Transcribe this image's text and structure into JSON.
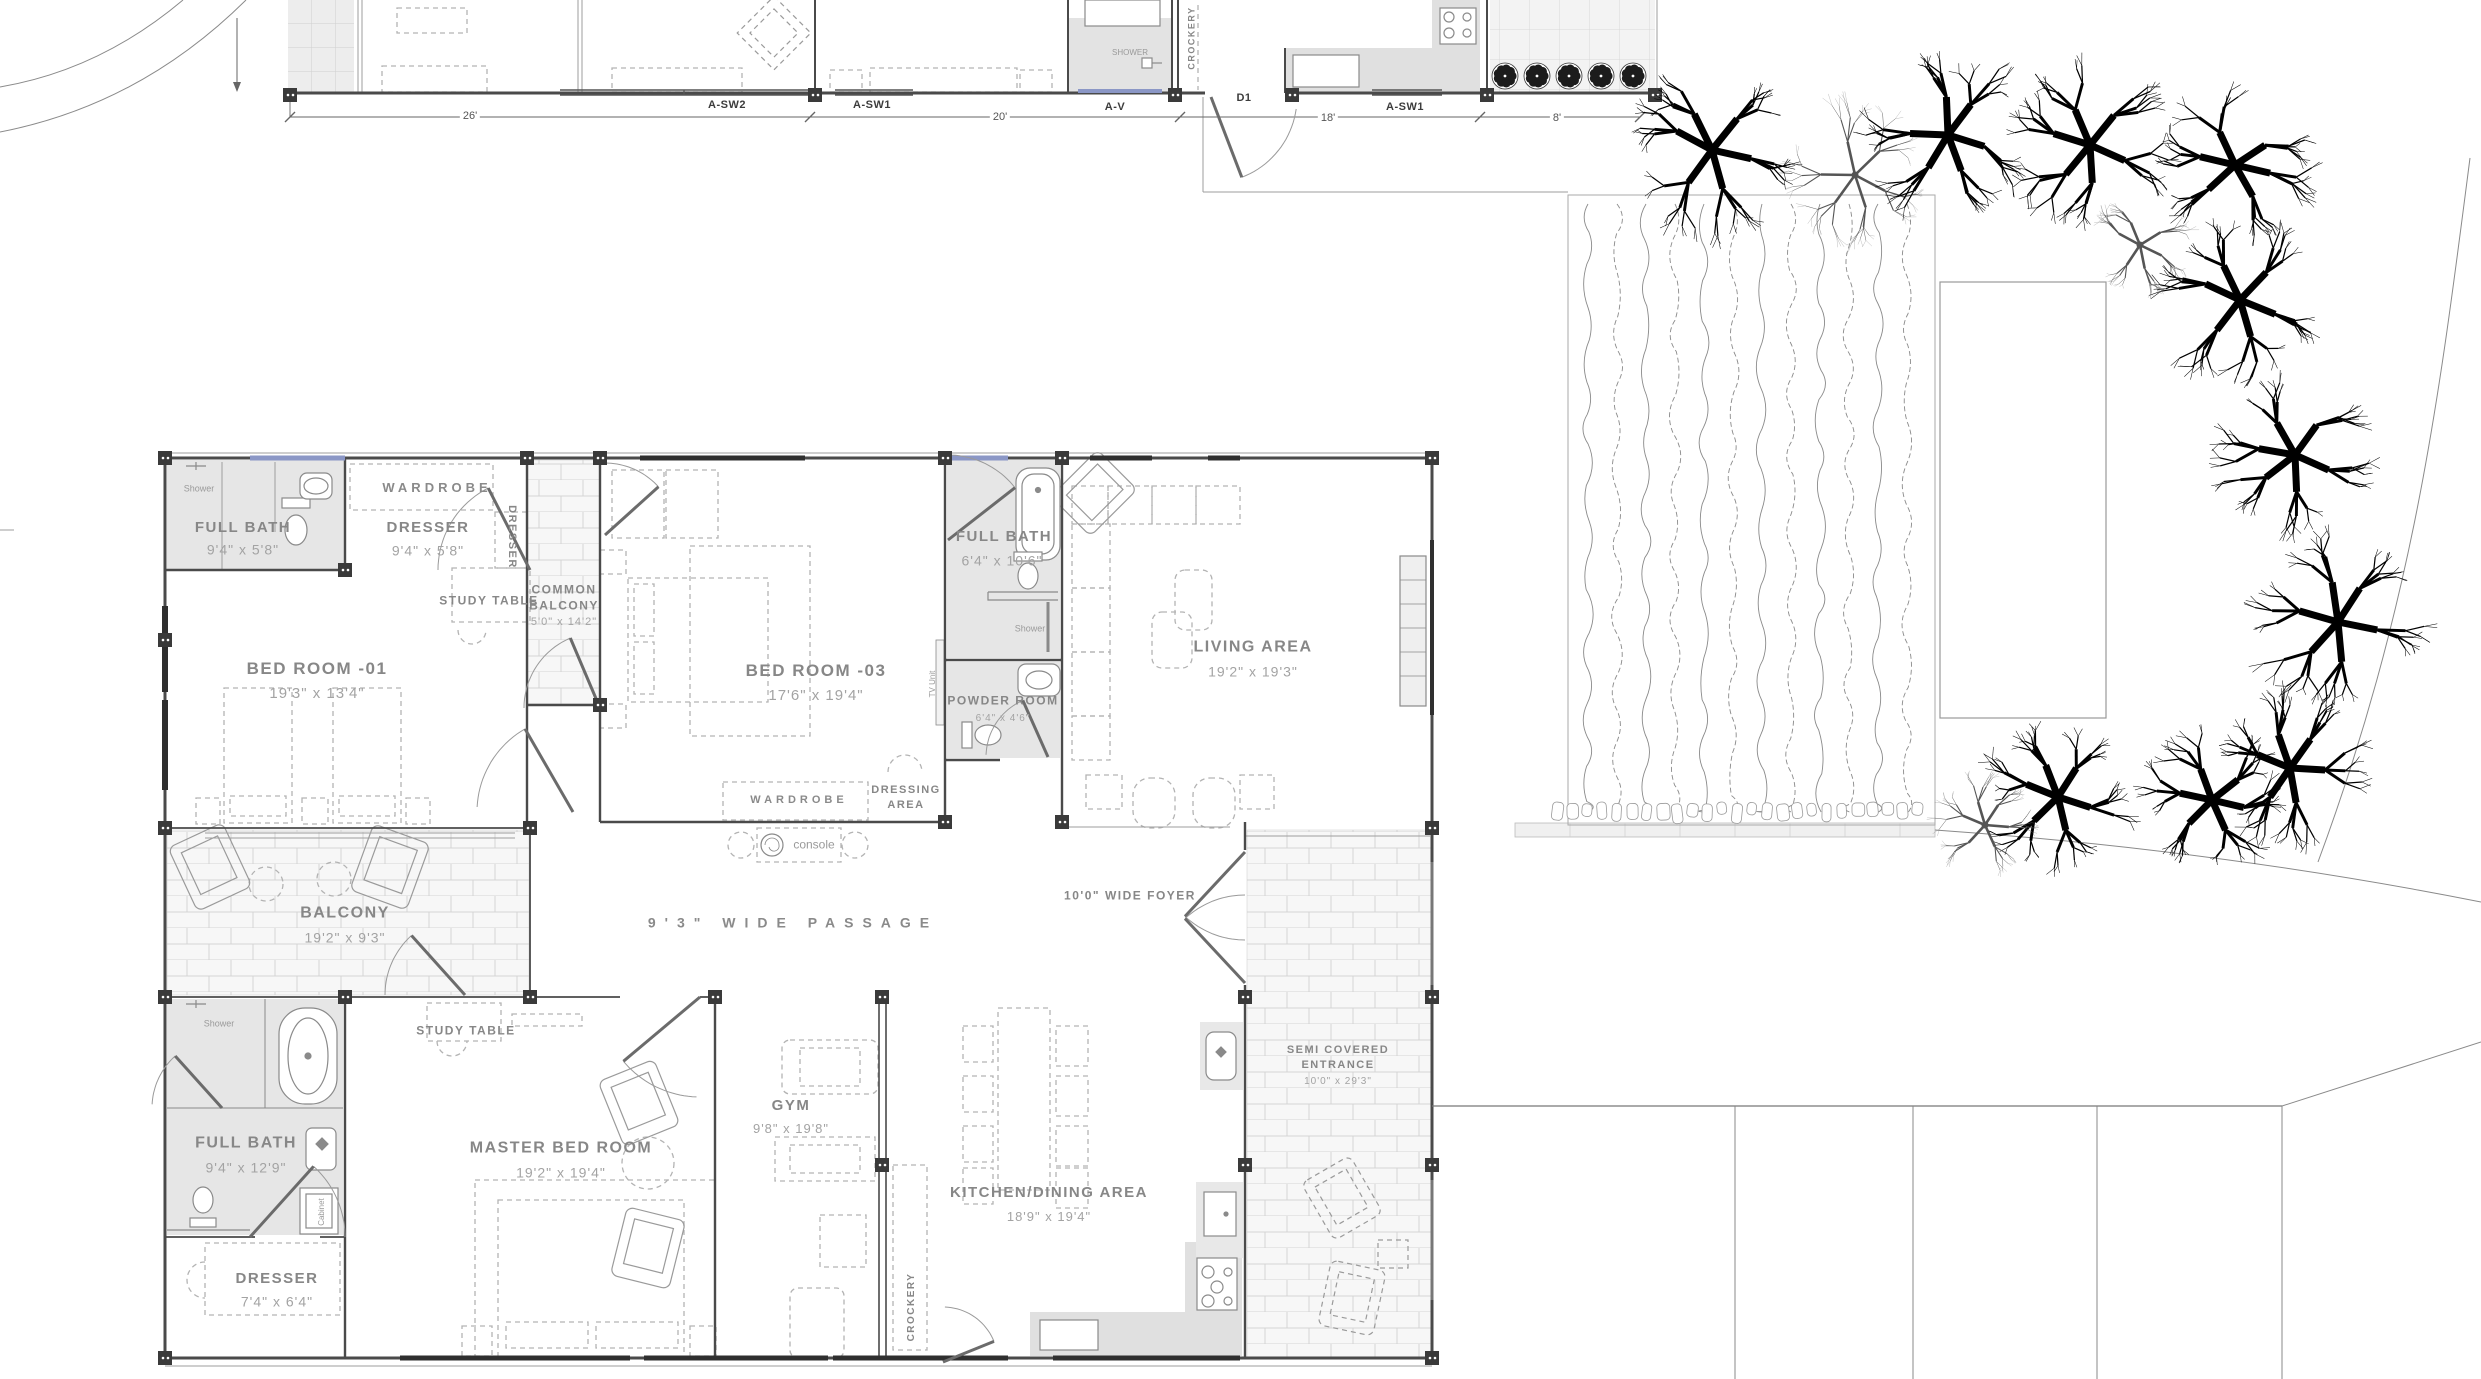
{
  "colors": {
    "wall": "#4a4a4a",
    "room_fill": "#e6e6e6",
    "brick_line": "#d4d4d4",
    "label": "#8f8f8f",
    "window_glass": "#8b97c6",
    "tree": "#000000"
  },
  "upper": {
    "windows": {
      "w1": "A-SW2",
      "w2": "A-SW1",
      "w3": "A-V",
      "w4": "D1",
      "w5": "A-SW1"
    },
    "dims": {
      "d1": "26'",
      "d2": "20'",
      "d3": "18'",
      "d4": "8'"
    },
    "shower": "SHOWER",
    "crockery": "CROCKERY"
  },
  "rooms": {
    "bed1": {
      "name": "BED ROOM -01",
      "dims": "19'3\" x 13'4\""
    },
    "bed1_bath": {
      "name": "FULL BATH",
      "dims": "9'4\" x 5'8\""
    },
    "bed1_dresser": {
      "name": "DRESSER",
      "dims": "9'4\" x 5'8\""
    },
    "wardrobe_top": "WARDROBE",
    "dresser_side": "DRESSER",
    "study_table_top": "STUDY TABLE",
    "common_balcony": {
      "line1": "COMMON",
      "line2": "BALCONY",
      "dims": "5'0\" x 14'2\""
    },
    "bed3": {
      "name": "BED ROOM -03",
      "dims": "17'6\" x 19'4\""
    },
    "bed3_bath": {
      "name": "FULL BATH",
      "dims": "6'4\" x 10'6\""
    },
    "powder": {
      "name": "POWDER ROOM",
      "dims": "6'4\" x 4'6\""
    },
    "living": {
      "name": "LIVING AREA",
      "dims": "19'2\" x 19'3\""
    },
    "wardrobe_mid": "WARDROBE",
    "dressing": {
      "line1": "DRESSING",
      "line2": "AREA"
    },
    "console": "console",
    "balcony": {
      "name": "BALCONY",
      "dims": "19'2\" x 9'3\""
    },
    "passage": "9'3\" WIDE PASSAGE",
    "foyer": "10'0\" WIDE FOYER",
    "study_table_master": "STUDY TABLE",
    "master": {
      "name": "MASTER BED ROOM",
      "dims": "19'2\" x 19'4\""
    },
    "master_bath": {
      "name": "FULL BATH",
      "dims": "9'4\" x 12'9\""
    },
    "master_dresser": {
      "name": "DRESSER",
      "dims": "7'4\" x 6'4\""
    },
    "gym": {
      "name": "GYM",
      "dims": "9'8\" x 19'8\""
    },
    "kitchen": {
      "name": "KITCHEN/DINING AREA",
      "dims": "18'9\" x 19'4\""
    },
    "crockery": "CROCKERY",
    "entrance": {
      "line1": "SEMI COVERED",
      "line2": "ENTRANCE",
      "dims": "10'0\" x 29'3\""
    },
    "shower_small": "Shower",
    "cabinet": "Cabinet",
    "tv_unit": "TV Unit"
  }
}
